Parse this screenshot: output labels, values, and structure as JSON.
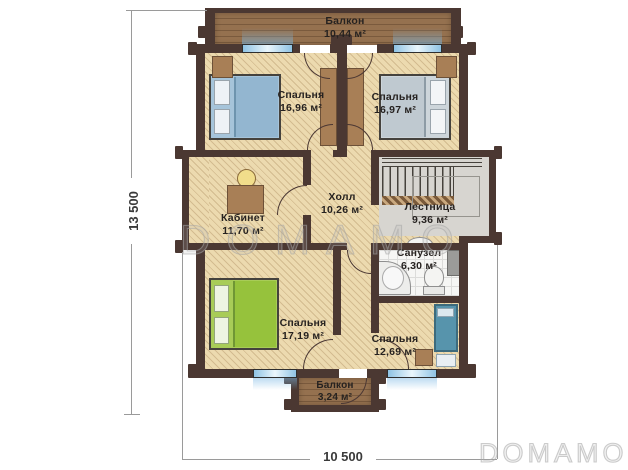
{
  "plan": {
    "rooms": {
      "balcony_top": {
        "name": "Балкон",
        "area": "10,44 м²"
      },
      "bedroom_top_left": {
        "name": "Спальня",
        "area": "16,96 м²"
      },
      "bedroom_top_right": {
        "name": "Спальня",
        "area": "16,97 м²"
      },
      "office": {
        "name": "Кабинет",
        "area": "11,70 м²"
      },
      "hall": {
        "name": "Холл",
        "area": "10,26 м²"
      },
      "stairs": {
        "name": "Лестница",
        "area": "9,36 м²"
      },
      "bathroom": {
        "name": "Санузел",
        "area": "6,30 м²"
      },
      "bedroom_bottom_left": {
        "name": "Спальня",
        "area": "17,19 м²"
      },
      "bedroom_bottom_right": {
        "name": "Спальня",
        "area": "12,69 м²"
      },
      "balcony_bottom": {
        "name": "Балкон",
        "area": "3,24 м²"
      }
    },
    "dimensions": {
      "height": "13 500",
      "width": "10 500"
    },
    "watermark": {
      "text": "DOMAMO"
    },
    "colors": {
      "wall": "#4b3832",
      "floor": "#ecdaaf",
      "wood": "#8a6749",
      "window_glass": "#8fc3e4",
      "bed_blue": "#a6c4da",
      "bed_gray": "#c6cfd5",
      "bed_green": "#9ac23c",
      "bed_teal": "#5794ac",
      "furniture": "#a87f56"
    }
  }
}
